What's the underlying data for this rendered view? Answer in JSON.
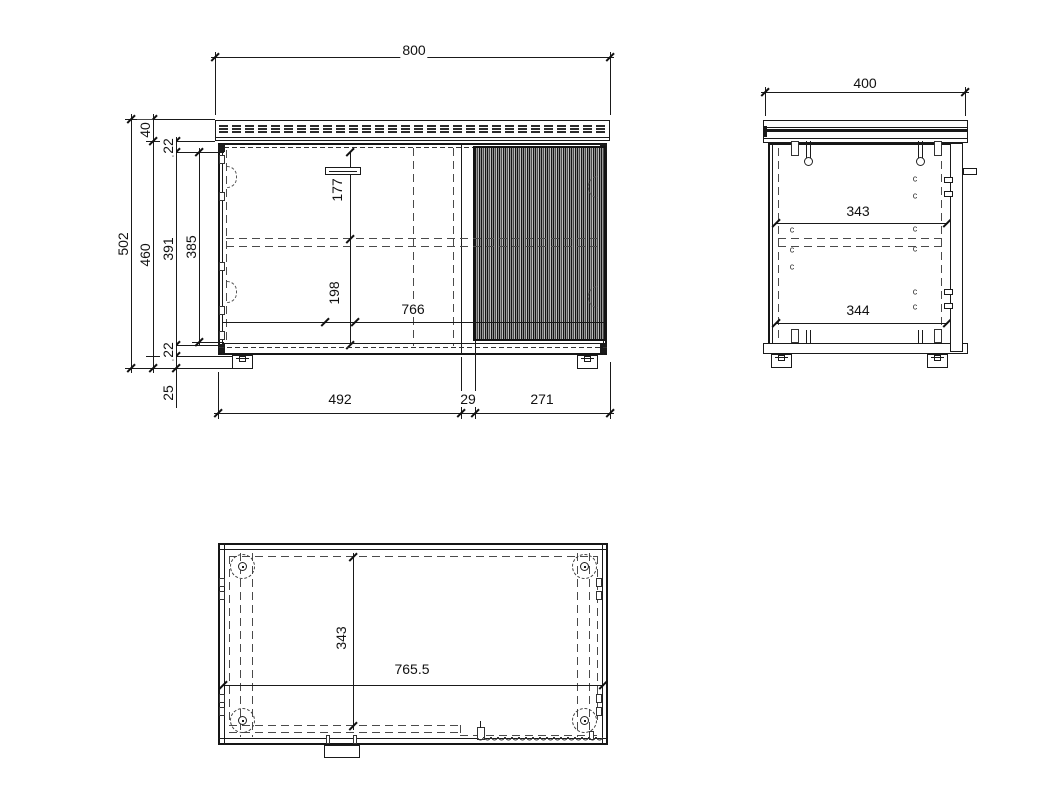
{
  "front": {
    "overall_width": "800",
    "top_panel": "40",
    "top_inset": "22",
    "overall_height": "502",
    "body_height": "460",
    "inner_height": "391",
    "door_height": "385",
    "bottom_inset": "22",
    "foot_height": "25",
    "handle_drop": "177",
    "shelf_drop": "198",
    "inner_width": "766",
    "left_section": "492",
    "mid_gap": "29",
    "right_section": "271"
  },
  "side": {
    "depth": "400",
    "upper_depth": "343",
    "lower_depth": "344"
  },
  "top": {
    "inner_depth": "343",
    "inner_width": "765.5"
  },
  "colors": {
    "line": "#1a1a1a",
    "dashed": "#444444",
    "flute_gray": "#9a9a9a",
    "background": "#ffffff"
  }
}
